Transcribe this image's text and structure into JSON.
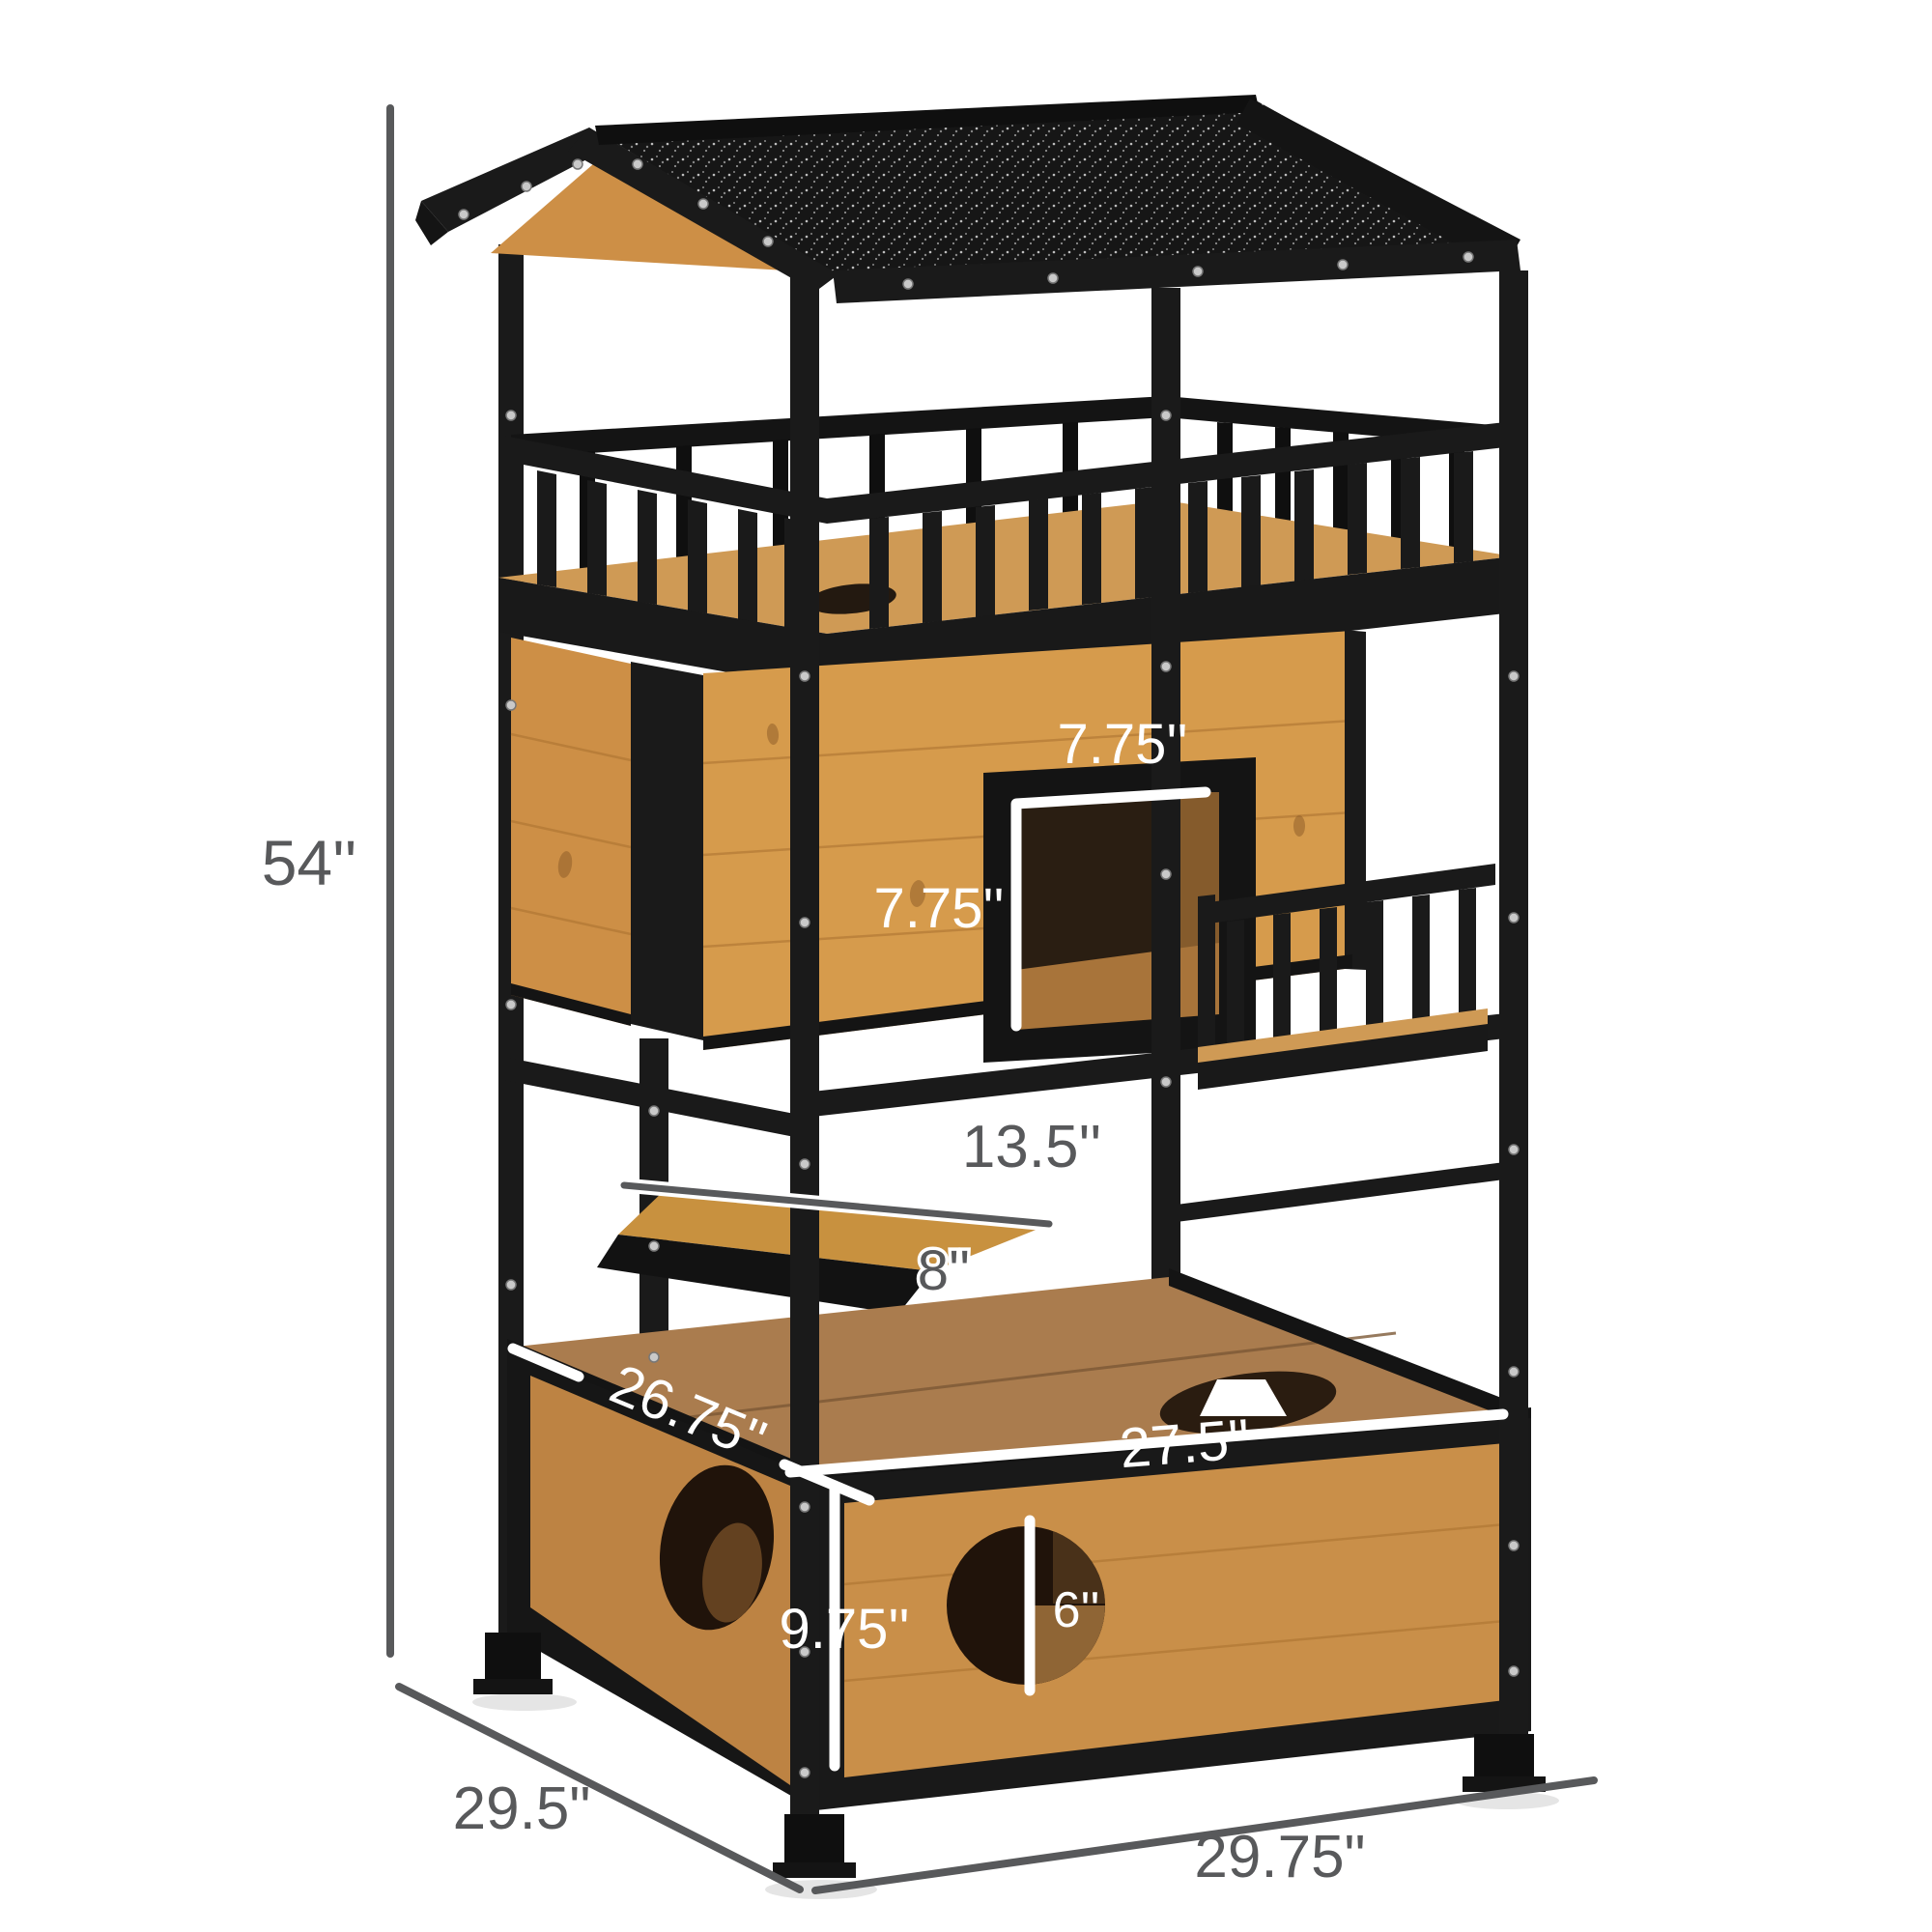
{
  "figure": {
    "title": "Outdoor wooden cat house tree with asphalt roof - dimension diagram",
    "type": "product-dimension-diagram",
    "background": "#ffffff"
  },
  "colors": {
    "frame_black": "#1a1a1a",
    "roof_black": "#161616",
    "wood_light": "#d69b4c",
    "wood_mid": "#c98f49",
    "wood_deep": "#aa7c4e",
    "dimension_gray": "#58595b",
    "dimension_white": "#ffffff"
  },
  "dims": {
    "overall_height": "54''",
    "base_depth": "29.5\"",
    "base_width": "29.75\"",
    "door_width": "7.75''",
    "door_height": "7.75''",
    "perch_length": "13.5''",
    "perch_depth": "8''",
    "box_top_depth": "26.75''",
    "box_top_width": "27.5''",
    "box_height": "9.75''",
    "hole_diameter": "6''"
  }
}
